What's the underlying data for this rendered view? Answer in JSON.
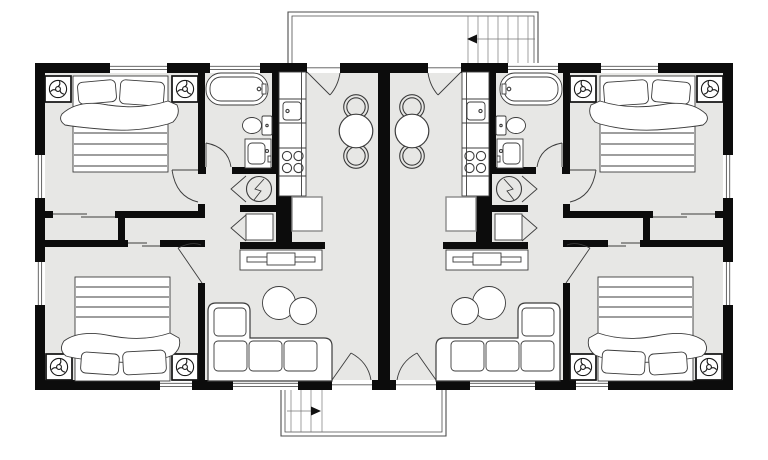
{
  "canvas": {
    "width": 768,
    "height": 460
  },
  "colors": {
    "wall": "#0c0c0c",
    "floor": "#e7e7e5",
    "line": "#4d4d4d",
    "thin": "#777777",
    "glass": "#555555",
    "furn": "#3c3c3c",
    "soft": "#8a8a8a"
  },
  "plan": {
    "type": "duplex-floor-plan",
    "units": 2,
    "mirrored": true,
    "unit": {
      "rooms": [
        "bedroom-front",
        "bedroom-back",
        "bathroom",
        "kitchen",
        "dining",
        "living",
        "hallway",
        "closets"
      ],
      "furniture_counts": {
        "double_beds": 2,
        "ceiling_fan_symbols": 4,
        "bathtub": 1,
        "toilet": 1,
        "vanity_sink": 1,
        "kitchen_sink": 1,
        "stove_burners": 4,
        "refrigerator": 1,
        "dining_table": 1,
        "dining_chairs": 2,
        "sectional_sofa": 1,
        "coffee_table_circles": 2,
        "tv_console": 1,
        "water_heater": 1,
        "closet_sliding_doors": 2,
        "closet_bifold_doors": 2
      }
    },
    "shared": {
      "rear_deck": {
        "has_stairs": true,
        "stair_arrow_direction": "left"
      },
      "front_porch": {
        "has_stairs": true,
        "stair_arrow_direction": "right"
      }
    }
  }
}
